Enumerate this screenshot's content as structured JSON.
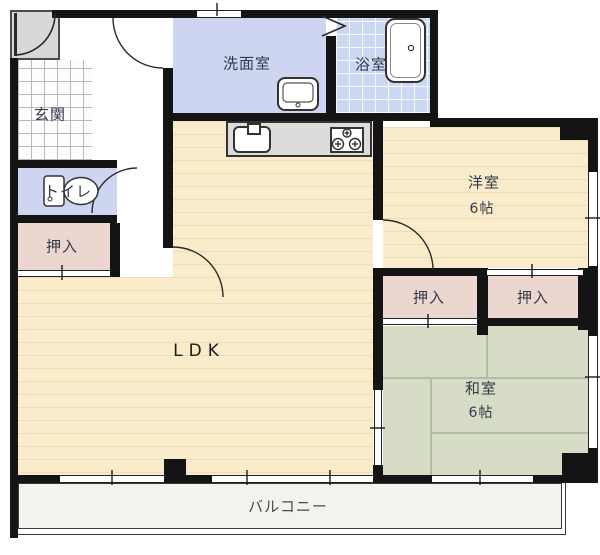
{
  "title": "2LDK apartment floor plan",
  "rooms": {
    "genkan": {
      "label": "玄関"
    },
    "washroom": {
      "label": "洗面室"
    },
    "bathroom": {
      "label": "浴室"
    },
    "toilet": {
      "label": "トイレ"
    },
    "closet_left": {
      "label": "押入"
    },
    "closet_middle": {
      "label": "押入"
    },
    "closet_right": {
      "label": "押入"
    },
    "western_room": {
      "label": "洋室",
      "size": "6帖"
    },
    "japanese_room": {
      "label": "和室",
      "size": "6帖"
    },
    "ldk": {
      "label": "LDK"
    },
    "balcony": {
      "label": "バルコニー"
    }
  },
  "colors": {
    "wall": "#141414",
    "wood_floor": "#faecca",
    "wood_line": "#e9ddba",
    "tatami": "#d6dcc5",
    "closet": "#ebd7cf",
    "wet_room": "#cdd5f0",
    "bath_tile": "#ccd8f2",
    "balcony": "#f2f2ef",
    "porch": "#d8d8d8"
  }
}
